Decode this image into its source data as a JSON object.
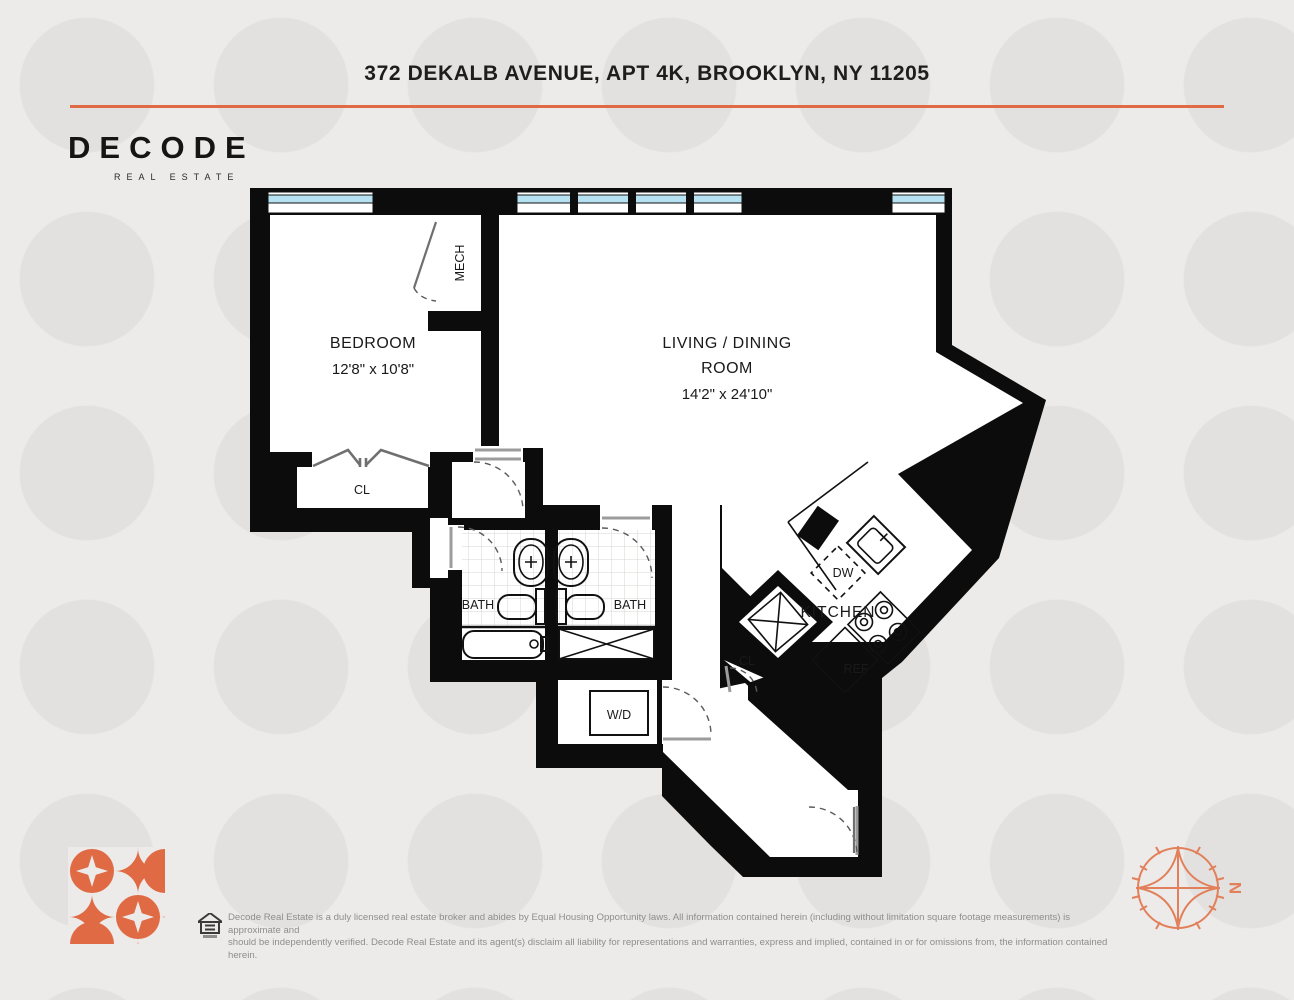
{
  "header": {
    "address": "372 DEKALB AVENUE, APT 4K, BROOKLYN, NY 11205"
  },
  "brand": {
    "name": "DECODE",
    "tagline": "REAL ESTATE"
  },
  "rooms": {
    "bedroom": {
      "label": "BEDROOM",
      "dimensions": "12'8\" x 10'8\""
    },
    "living": {
      "label_line1": "LIVING / DINING",
      "label_line2": "ROOM",
      "dimensions": "14'2\" x 24'10\""
    },
    "kitchen": {
      "label": "KITCHEN"
    },
    "mech": {
      "label": "MECH"
    },
    "closet_bedroom": {
      "label": "CL"
    },
    "closet_hall": {
      "label": "CL"
    },
    "bath_left": {
      "label": "BATH"
    },
    "bath_right": {
      "label": "BATH"
    },
    "washer_dryer": {
      "label": "W/D"
    },
    "dishwasher": {
      "label": "DW"
    },
    "refrigerator": {
      "label": "REF"
    }
  },
  "compass": {
    "north_label": "N"
  },
  "footer": {
    "disclaimer_line1": "Decode Real Estate is a duly licensed real estate broker and abides by Equal Housing Opportunity laws. All information contained herein (including without limitation square footage measurements) is approximate and",
    "disclaimer_line2": "should be independently verified. Decode Real Estate and its agent(s) disclaim all liability for representations and warranties, express and implied, contained in or for omissions from, the information contained herein."
  },
  "colors": {
    "accent": "#df6a43",
    "wall": "#0c0c0c",
    "window_glass": "#b5e1f1"
  }
}
